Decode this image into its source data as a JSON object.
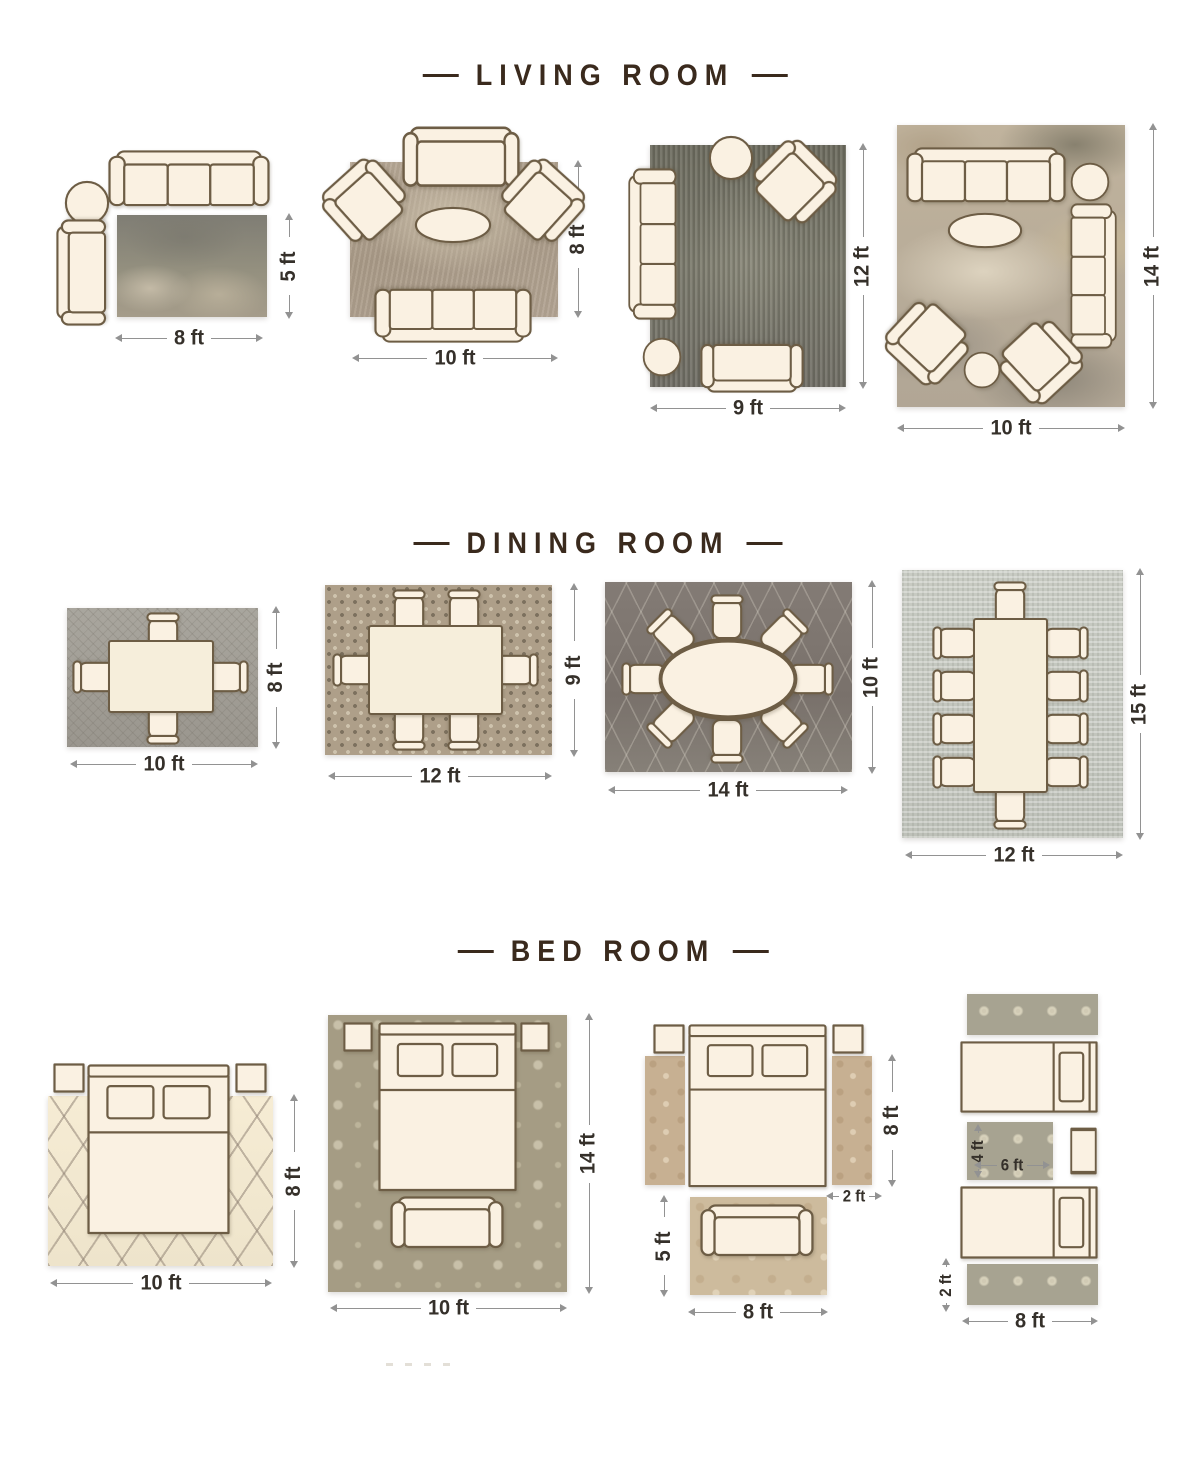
{
  "page": {
    "background": "#ffffff"
  },
  "palette": {
    "title_color": "#3a2a1d",
    "furniture_fill": "#faf1e2",
    "furniture_outline": "#6d5d45",
    "dimension_line_color": "#929292",
    "dimension_text_color": "#35302a"
  },
  "furniture_types": [
    "sofa",
    "loveseat",
    "armchair",
    "round-side-table",
    "oval-coffee-table",
    "dining-table",
    "dining-chair",
    "bed",
    "twin-bed",
    "nightstand",
    "bench",
    "area-rug",
    "runner-rug"
  ],
  "sections": {
    "living": {
      "title": "LIVING ROOM",
      "layouts": [
        {
          "width_label": "8 ft",
          "height_label": "5 ft"
        },
        {
          "width_label": "10 ft",
          "height_label": "8 ft"
        },
        {
          "width_label": "9 ft",
          "height_label": "12 ft"
        },
        {
          "width_label": "10 ft",
          "height_label": "14 ft"
        }
      ]
    },
    "dining": {
      "title": "DINING ROOM",
      "layouts": [
        {
          "width_label": "10 ft",
          "height_label": "8 ft"
        },
        {
          "width_label": "12 ft",
          "height_label": "9 ft"
        },
        {
          "width_label": "14 ft",
          "height_label": "10 ft"
        },
        {
          "width_label": "12 ft",
          "height_label": "15 ft"
        }
      ]
    },
    "bedroom": {
      "title": "BED ROOM",
      "layouts": [
        {
          "width_label": "10 ft",
          "height_label": "8 ft"
        },
        {
          "width_label": "10 ft",
          "height_label": "14 ft"
        },
        {
          "runner_height_label": "8 ft",
          "runner_width_label": "2 ft",
          "foot_rug_height_label": "5 ft",
          "foot_rug_width_label": "8 ft"
        },
        {
          "accent_rug_height_label": "4 ft",
          "accent_rug_width_label": "6 ft",
          "runner_width_label": "2 ft",
          "runner_length_label": "8 ft"
        }
      ]
    }
  }
}
